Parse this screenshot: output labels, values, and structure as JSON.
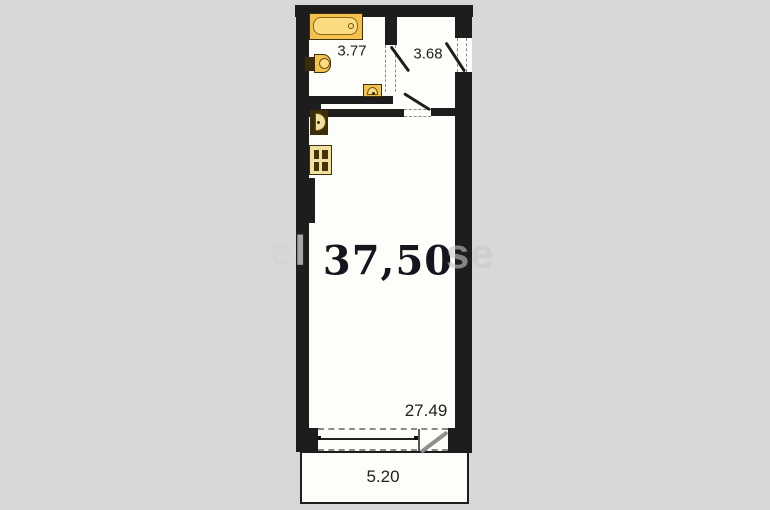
{
  "title": "apartment-floor-plan",
  "colors": {
    "wall": "#1d1d1d",
    "background": "#d8d8d8",
    "floor": "#fdfdfa",
    "fixture": "#f2c14e",
    "fixture_light": "#fbda80",
    "fixture_pale": "#f0e0a0",
    "fixture_dark": "#3a2d0a",
    "fixture_border": "#3e3008",
    "dash": "#8a8a8a",
    "door_gray": "#8f8f8f",
    "text": "#1f1f1f"
  },
  "rooms": {
    "bathroom": {
      "area": "3.77"
    },
    "hallway": {
      "area": "3.68"
    },
    "main_room": {
      "area": "37,50"
    },
    "balcony": {
      "area": "5.20"
    }
  },
  "dimensions": {
    "window_width": "27.49"
  },
  "fixtures": [
    "bathtub",
    "toilet",
    "bathroom-sink",
    "kitchen-sink",
    "stove"
  ],
  "watermark": {
    "left_fragment": "el",
    "right_fragment": "se"
  }
}
